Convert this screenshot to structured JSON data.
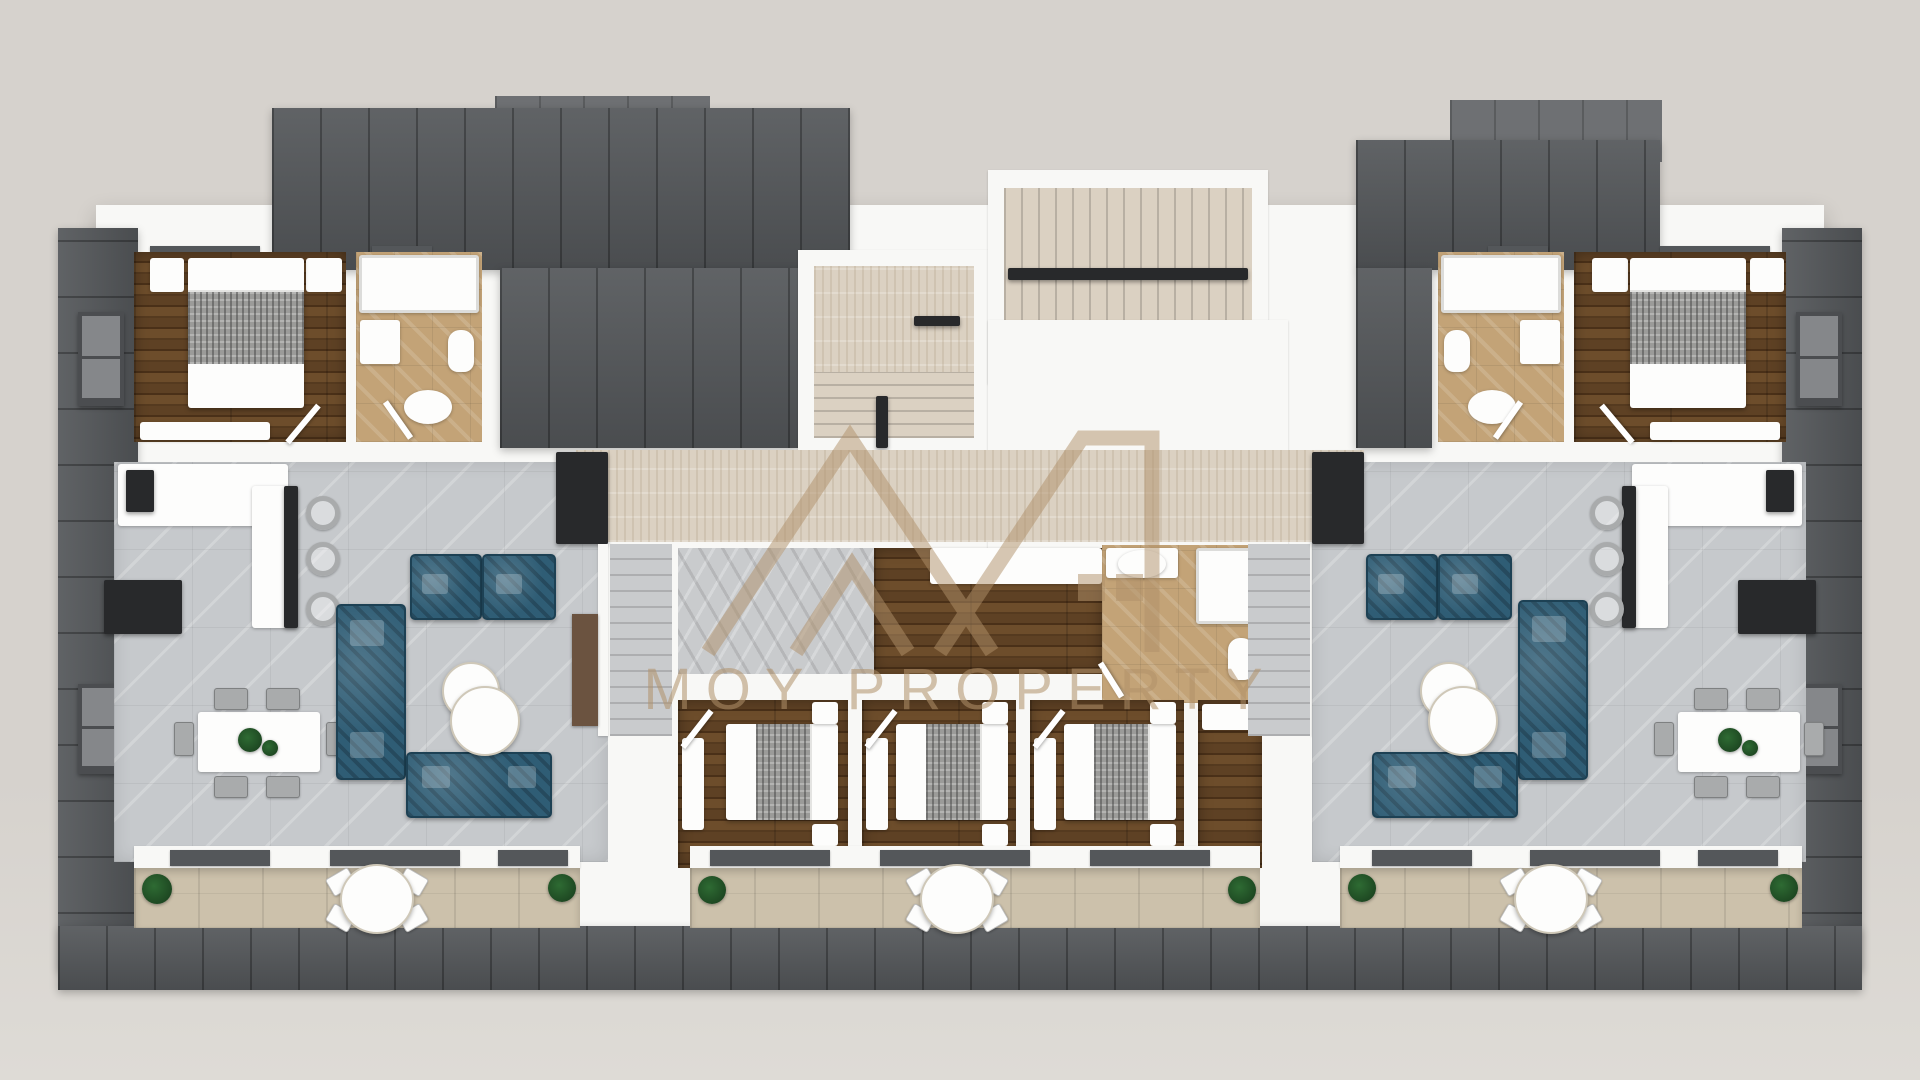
{
  "watermark": {
    "logo": "moy-property-roofline-logo",
    "text": "MOY PROPERTY"
  },
  "palette": {
    "bg": "#d6d2cd",
    "bg_light": "#dedbd6",
    "roof_dark": "#54575a",
    "roof_light": "#6e7073",
    "wall": "#f8f8f6",
    "wood_a": "#5e4124",
    "wood_b": "#4a3018",
    "wood_c": "#6d4d2b",
    "wood_d": "#553a1f",
    "tile_gray": "#c6c9cc",
    "travertine": "#dbd1c2",
    "bath_tan": "#c3a377",
    "balcony_tile": "#ccc1ab",
    "stair_gray": "#c9cbcd",
    "sofa_teal": "#2f5d75",
    "sofa_teal_dark": "#1d4154",
    "console_brown": "#6b5340",
    "black_unit": "#28292b",
    "plant": "#2e6b33",
    "wm": "#b1916a",
    "blanket": "#9b9b99",
    "chair_gray": "#a9abac",
    "win_frame": "#4b4d50",
    "win_pane": "#85878a",
    "table_white": "#fdfdfc"
  },
  "scene": {
    "type": "3d-top-down-floor-plan-render",
    "units": [
      "left-apartment",
      "central-apartment",
      "right-apartment"
    ],
    "rooms": [
      "bedroom-top-left",
      "bathroom-top-left",
      "living-kitchen-left",
      "stairwell-top-center",
      "hallway-center",
      "bathroom-center",
      "bedroom-center-1",
      "bedroom-center-2",
      "bedroom-center-3",
      "bathroom-top-right",
      "bedroom-top-right",
      "living-kitchen-right",
      "balcony-left",
      "balcony-center",
      "balcony-right"
    ]
  }
}
